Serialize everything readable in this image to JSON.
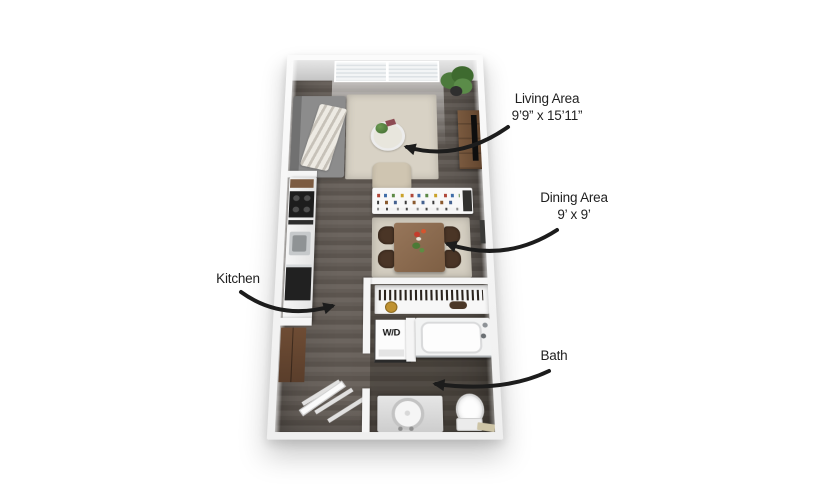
{
  "labels": {
    "living": {
      "title": "Living Area",
      "dims": "9’9” x 15’11”"
    },
    "dining": {
      "title": "Dining Area",
      "dims": "9’ x 9’"
    },
    "kitchen": {
      "title": "Kitchen"
    },
    "bath": {
      "title": "Bath"
    }
  },
  "plan": {
    "washer_dryer_label": "W/D"
  },
  "palette": {
    "arrow": "#1c1c1c",
    "text": "#1f1f1f",
    "rug": "#d8d2c5",
    "floor": "#665f59",
    "bath_floor": "#4c453f",
    "wall": "#f5f5f5",
    "table_wood": "#8b6a4d",
    "console_wood": "#6f5139"
  }
}
